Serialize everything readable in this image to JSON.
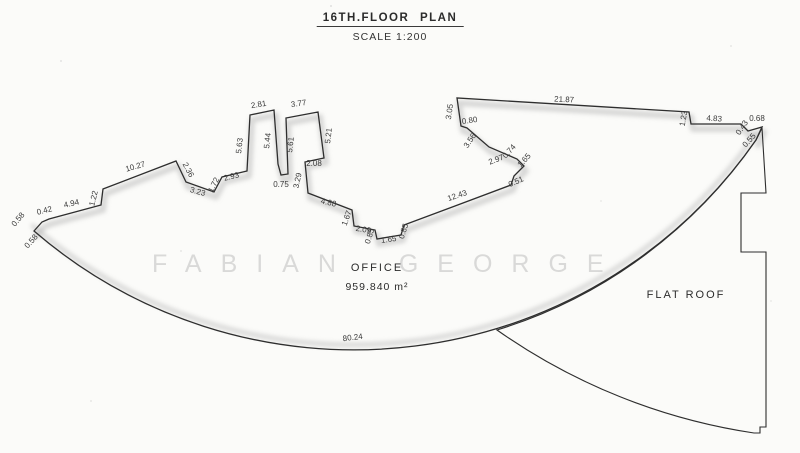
{
  "title": {
    "text": "16TH.FLOOR PLAN",
    "scale": "SCALE 1:200"
  },
  "watermark": {
    "text": "FABIAN GEORGE"
  },
  "office": {
    "name": "OFFICE",
    "area": "959.840 m²"
  },
  "flat_roof": {
    "name": "FLAT ROOF"
  },
  "drawing": {
    "ink": "#2e2e2e",
    "shade": "#b4b4b4",
    "paper": "#fbfbf9",
    "outline_path": "M34,231 L42,222 L49,219 L101,205 L103,189 L176,161 L186,182 L214,192 L222,177 L247,171 L250,115 L274,110 L278,164 L281,175 L288,174 L286,118 L318,112 L324,158 L305,162 L308,193 L352,210 L354,226 L375,230 L377,239 L401,235 L404,225 L455,206 L511,185 L514,176 L524,166 L517,159 L489,147 L467,128 L461,126 L457,98 L689,112 L691,124 L741,124 L748,131 L762,127 L756,140 A490 490 0 0 1 34,231 Z",
    "top_edge_path": "M34,231 L42,222 L49,219 L101,205 L103,189 L176,161 L186,182 L214,192 L222,177 L247,171 L250,115 L274,110 L278,164 L281,175 L288,174 L286,118 L318,112 L324,158 L305,162 L308,193 L352,210 L354,226 L375,230 L377,239 L401,235 L404,225 L455,206 L511,185 L514,176 L524,166 L517,159 L489,147 L467,128 L461,126 L457,98 L689,112 L691,124 L741,124 L748,131 L762,127 L756,140",
    "bottom_arc_path": "M756,140 A490 490 0 0 1 34,231",
    "flat_roof_path": "M762,128 L766,193 L741,193 L741,252 L766,252 L766,427 L760,427 L760,433 L754,433 A600 600 0 0 1 497,330 A490 490 0 0 0 756,140 Z"
  },
  "dimensions": [
    {
      "label": "0.58",
      "x": 20,
      "y": 221,
      "r": -50
    },
    {
      "label": "0.42",
      "x": 45,
      "y": 213,
      "r": -14
    },
    {
      "label": "4.94",
      "x": 72,
      "y": 206,
      "r": -13
    },
    {
      "label": "1.22",
      "x": 96,
      "y": 199,
      "r": -76
    },
    {
      "label": "10.27",
      "x": 136,
      "y": 169,
      "r": -16
    },
    {
      "label": "2.36",
      "x": 186,
      "y": 171,
      "r": 62
    },
    {
      "label": "3.23",
      "x": 197,
      "y": 194,
      "r": 16
    },
    {
      "label": "1.72",
      "x": 216,
      "y": 186,
      "r": -64
    },
    {
      "label": "2.93",
      "x": 232,
      "y": 179,
      "r": -14
    },
    {
      "label": "5.63",
      "x": 242,
      "y": 146,
      "r": -84
    },
    {
      "label": "2.81",
      "x": 259,
      "y": 107,
      "r": -9
    },
    {
      "label": "5.44",
      "x": 270,
      "y": 141,
      "r": -84
    },
    {
      "label": "0.75",
      "x": 281,
      "y": 187,
      "r": 0
    },
    {
      "label": "5.61",
      "x": 293,
      "y": 145,
      "r": -84
    },
    {
      "label": "3.77",
      "x": 299,
      "y": 106,
      "r": -8
    },
    {
      "label": "5.21",
      "x": 331,
      "y": 136,
      "r": -84
    },
    {
      "label": "2.08",
      "x": 314,
      "y": 166,
      "r": 0
    },
    {
      "label": "3.29",
      "x": 300,
      "y": 181,
      "r": -78
    },
    {
      "label": "4.88",
      "x": 328,
      "y": 205,
      "r": 13
    },
    {
      "label": "1.67",
      "x": 349,
      "y": 219,
      "r": -70
    },
    {
      "label": "2.09",
      "x": 363,
      "y": 232,
      "r": 9
    },
    {
      "label": "0.85",
      "x": 372,
      "y": 237,
      "r": -72
    },
    {
      "label": "1.65",
      "x": 389,
      "y": 242,
      "r": -8
    },
    {
      "label": "0.85",
      "x": 406,
      "y": 232,
      "r": -72
    },
    {
      "label": "12.43",
      "x": 458,
      "y": 198,
      "r": -19
    },
    {
      "label": "0.51",
      "x": 517,
      "y": 184,
      "r": -24
    },
    {
      "label": "1.65",
      "x": 526,
      "y": 162,
      "r": -48
    },
    {
      "label": "0.74",
      "x": 511,
      "y": 153,
      "r": -48
    },
    {
      "label": "2.97",
      "x": 497,
      "y": 162,
      "r": -21
    },
    {
      "label": "3.56",
      "x": 472,
      "y": 142,
      "r": -56
    },
    {
      "label": "0.80",
      "x": 470,
      "y": 123,
      "r": -8
    },
    {
      "label": "3.05",
      "x": 452,
      "y": 112,
      "r": -82
    },
    {
      "label": "21.87",
      "x": 564,
      "y": 102,
      "r": 3
    },
    {
      "label": "1.23",
      "x": 686,
      "y": 119,
      "r": -80
    },
    {
      "label": "4.83",
      "x": 714,
      "y": 121,
      "r": 4
    },
    {
      "label": "0.43",
      "x": 744,
      "y": 129,
      "r": -56
    },
    {
      "label": "0.68",
      "x": 757,
      "y": 121,
      "r": 0
    },
    {
      "label": "0.55",
      "x": 751,
      "y": 142,
      "r": -48
    },
    {
      "label": "0.58",
      "x": 33,
      "y": 243,
      "r": -48
    },
    {
      "label": "80.24",
      "x": 353,
      "y": 340,
      "r": -7
    }
  ]
}
